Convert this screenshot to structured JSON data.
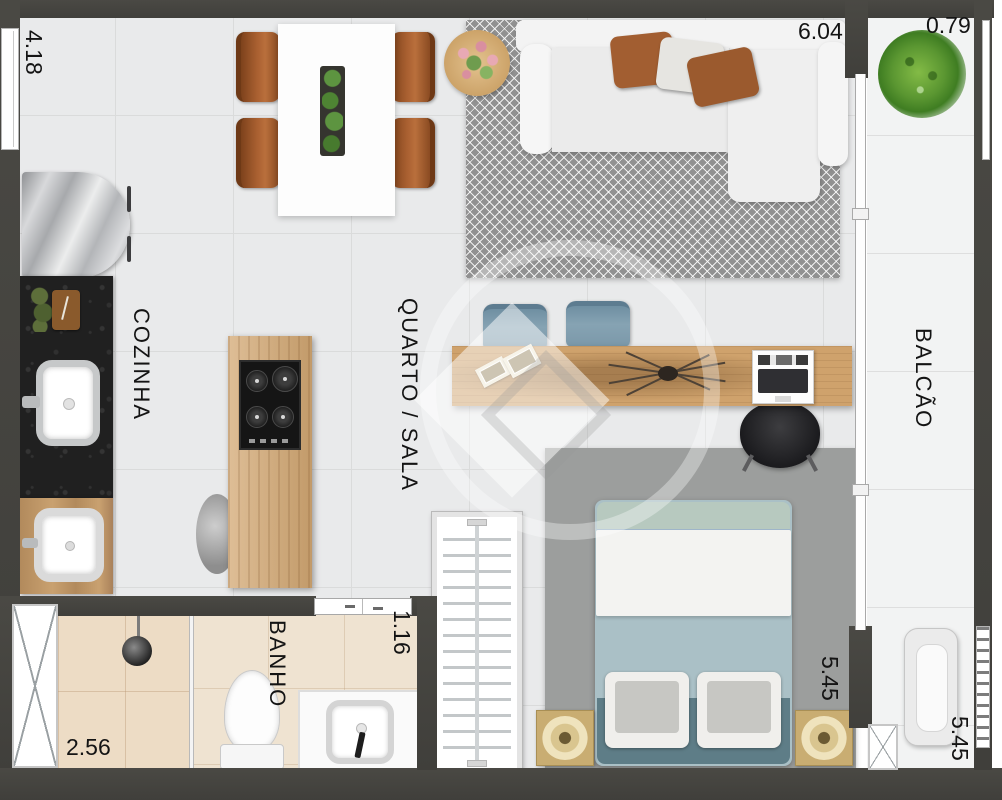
{
  "plan_type": "studio-apartment-floor-plan",
  "rooms": {
    "kitchen": {
      "label": "COZINHA"
    },
    "living": {
      "label": "QUARTO / SALA"
    },
    "balcony": {
      "label": "BALCÃO"
    },
    "bathroom": {
      "label": "BANHO"
    }
  },
  "dimensions": {
    "left_wall": "4.18",
    "living_width": "6.04",
    "balcony_width": "0.79",
    "bathroom_width": "2.56",
    "bathroom_entry": "1.16",
    "bedroom_depth": "5.45",
    "balcony_depth": "5.45"
  },
  "colors": {
    "wall": "#45443f",
    "floor_main": "#e9eaeb",
    "floor_balcony": "#f2f3f3",
    "floor_bathroom": "#efe3d1",
    "floor_shower": "#eddcc5",
    "rug_living": "#919191",
    "rug_bedroom": "#9c9e9d",
    "wood": "#cfa26c",
    "granite_counter": "#202020",
    "chair_brown": "#a85f30",
    "pillow_brown": "#a25e31",
    "chair_blue": "#7e9aab",
    "bed_sheet": "#aac0c6",
    "bed_footer": "#5e7d87",
    "nightstand_gold": "#c9ad72",
    "plant_green": "#5a9631"
  },
  "furniture": {
    "kitchen": [
      "refrigerator",
      "granite-counter",
      "cutting-board",
      "kitchen-sink",
      "laundry-tub",
      "island-cooktop",
      "stool"
    ],
    "dining": [
      "dining-table",
      "dining-chairs-x4",
      "planter-centerpiece",
      "side-table-with-flowers"
    ],
    "living": [
      "l-shaped-sofa",
      "throw-pillows-x3",
      "chevron-rug",
      "desk",
      "desk-chairs-x2",
      "laptop",
      "picture-frames",
      "branch-decor",
      "office-chair"
    ],
    "bedroom": [
      "double-bed",
      "pillows-x2",
      "nightstands-x2",
      "clothes-rack",
      "area-rug"
    ],
    "bathroom": [
      "shower",
      "toilet",
      "sink-counter"
    ],
    "balcony": [
      "potted-plant",
      "ac-unit"
    ]
  }
}
